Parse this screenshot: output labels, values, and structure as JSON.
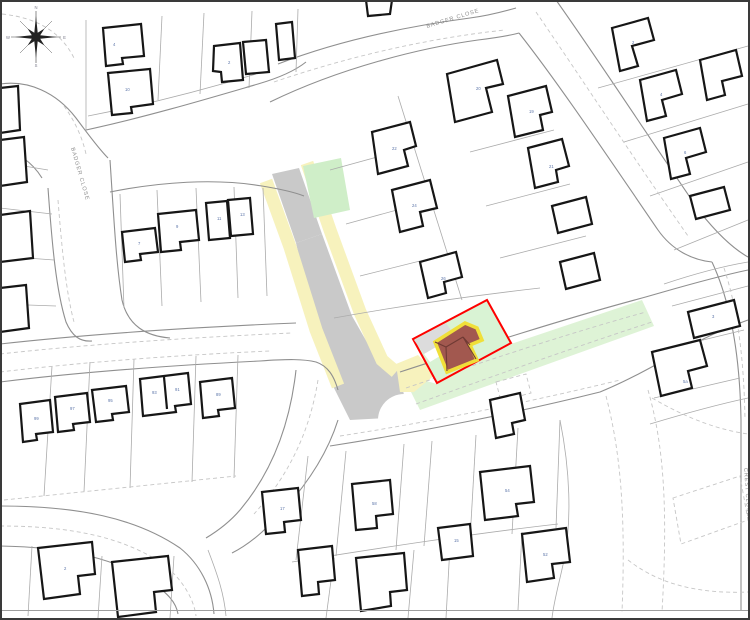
{
  "map": {
    "type": "site-location-plan",
    "streets": {
      "top": {
        "label": "BADGER CLOSE"
      },
      "left": {
        "label": "BADGER CLOSE"
      },
      "right": {
        "label": "CREST CLOSE"
      }
    },
    "compass": {
      "letters": [
        "N",
        "E",
        "S",
        "W"
      ]
    },
    "site": {
      "boundary_color": "#fe0000",
      "greenspace_color": "#d9f3d4",
      "verge_color": "#def3d6",
      "building_fill": "#a2584f",
      "building_outline": "#f0df39",
      "roof_line_color": "#6f3a34",
      "driveway_color": "#dcdcdc"
    },
    "road_colors": {
      "carriageway": "#c9c9c9",
      "footway": "#f7f2bd",
      "green_patch": "#cfeec8"
    },
    "house_labels": [
      {
        "x": 113,
        "y": 46,
        "t": "4"
      },
      {
        "x": 125,
        "y": 91,
        "t": "10"
      },
      {
        "x": 228,
        "y": 64,
        "t": "2"
      },
      {
        "x": 476,
        "y": 90,
        "t": "20"
      },
      {
        "x": 392,
        "y": 150,
        "t": "22"
      },
      {
        "x": 412,
        "y": 207,
        "t": "24"
      },
      {
        "x": 441,
        "y": 280,
        "t": "26"
      },
      {
        "x": 529,
        "y": 113,
        "t": "19"
      },
      {
        "x": 549,
        "y": 168,
        "t": "21"
      },
      {
        "x": 632,
        "y": 44,
        "t": "2"
      },
      {
        "x": 660,
        "y": 96,
        "t": "4"
      },
      {
        "x": 684,
        "y": 154,
        "t": "6"
      },
      {
        "x": 712,
        "y": 318,
        "t": "3"
      },
      {
        "x": 683,
        "y": 383,
        "t": "5a"
      },
      {
        "x": 138,
        "y": 245,
        "t": "7"
      },
      {
        "x": 176,
        "y": 228,
        "t": "9"
      },
      {
        "x": 217,
        "y": 220,
        "t": "11"
      },
      {
        "x": 240,
        "y": 216,
        "t": "13"
      },
      {
        "x": 34,
        "y": 420,
        "t": "99"
      },
      {
        "x": 70,
        "y": 410,
        "t": "97"
      },
      {
        "x": 108,
        "y": 402,
        "t": "95"
      },
      {
        "x": 152,
        "y": 394,
        "t": "93"
      },
      {
        "x": 175,
        "y": 391,
        "t": "91"
      },
      {
        "x": 216,
        "y": 396,
        "t": "89"
      },
      {
        "x": 64,
        "y": 570,
        "t": "2"
      },
      {
        "x": 280,
        "y": 510,
        "t": "17"
      },
      {
        "x": 372,
        "y": 505,
        "t": "58"
      },
      {
        "x": 454,
        "y": 542,
        "t": "15"
      },
      {
        "x": 505,
        "y": 492,
        "t": "54"
      },
      {
        "x": 543,
        "y": 556,
        "t": "52"
      }
    ]
  }
}
